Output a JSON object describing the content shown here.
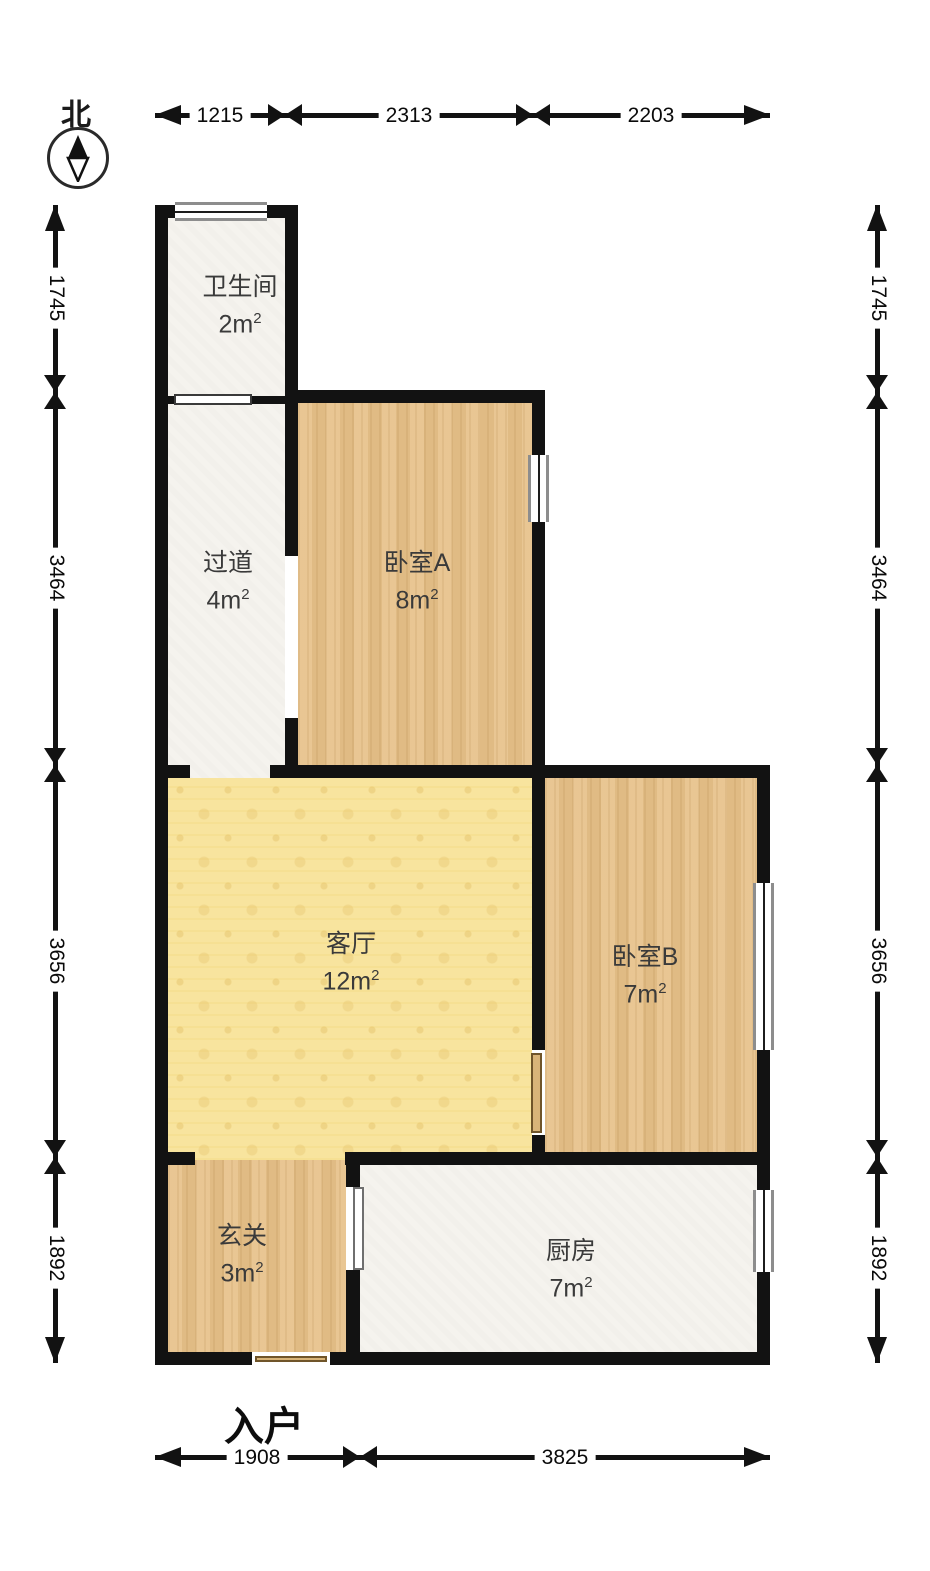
{
  "compass": {
    "north": "北"
  },
  "entrance_label": "入户",
  "rooms": [
    {
      "key": "bathroom",
      "name": "卫生间",
      "area": "2m",
      "sup": "2"
    },
    {
      "key": "hallway",
      "name": "过道",
      "area": "4m",
      "sup": "2"
    },
    {
      "key": "bedroom_a",
      "name": "卧室A",
      "area": "8m",
      "sup": "2"
    },
    {
      "key": "living",
      "name": "客厅",
      "area": "12m",
      "sup": "2"
    },
    {
      "key": "bedroom_b",
      "name": "卧室B",
      "area": "7m",
      "sup": "2"
    },
    {
      "key": "entry",
      "name": "玄关",
      "area": "3m",
      "sup": "2"
    },
    {
      "key": "kitchen",
      "name": "厨房",
      "area": "7m",
      "sup": "2"
    }
  ],
  "dimensions": {
    "top": [
      "1215",
      "2313",
      "2203"
    ],
    "bottom": [
      "1908",
      "3825"
    ],
    "left": [
      "1745",
      "3464",
      "3656",
      "1892"
    ],
    "right": [
      "1745",
      "3464",
      "3656",
      "1892"
    ]
  },
  "colors": {
    "wall": "#121212",
    "wood": "#e7c28b",
    "living": "#f8e49e",
    "light": "#f5f3ee",
    "door": "#d9b478"
  }
}
